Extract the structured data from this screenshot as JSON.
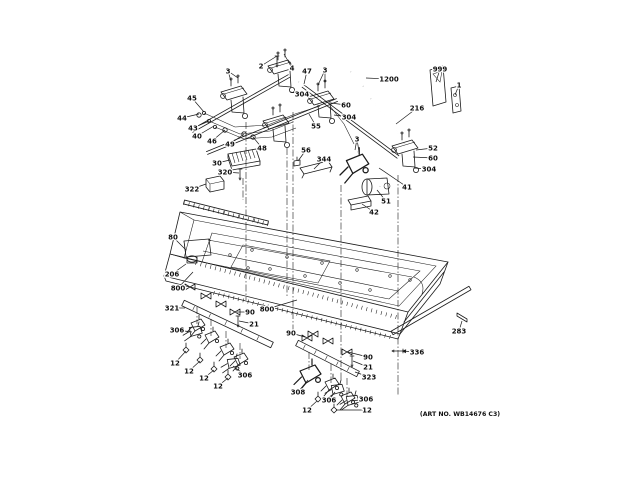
{
  "figure": {
    "art_no": "(ART NO. WB14676 C3)",
    "colors": {
      "line": "#1a1a1a",
      "background": "#ffffff",
      "label": "#111111"
    }
  },
  "callouts": [
    {
      "t": "3",
      "x": 228,
      "y": 71,
      "a": [
        [
          231,
          81
        ],
        [
          238,
          78
        ]
      ]
    },
    {
      "t": "2",
      "x": 261,
      "y": 66,
      "a": [
        [
          277,
          56
        ]
      ]
    },
    {
      "t": "4",
      "x": 292,
      "y": 68,
      "a": [
        [
          284,
          54
        ]
      ]
    },
    {
      "t": "47",
      "x": 307,
      "y": 71,
      "a": [
        [
          304,
          84
        ]
      ]
    },
    {
      "t": "3",
      "x": 325,
      "y": 70,
      "a": [
        [
          318,
          85
        ],
        [
          325,
          82
        ]
      ]
    },
    {
      "t": "45",
      "x": 192,
      "y": 98,
      "a": [
        [
          204,
          112
        ]
      ]
    },
    {
      "t": "304",
      "x": 302,
      "y": 94,
      "a": [
        [
          290,
          92
        ]
      ]
    },
    {
      "t": "60",
      "x": 346,
      "y": 105,
      "a": [
        [
          331,
          103
        ]
      ]
    },
    {
      "t": "44",
      "x": 182,
      "y": 118,
      "a": [
        [
          199,
          114
        ]
      ]
    },
    {
      "t": "304",
      "x": 349,
      "y": 117,
      "a": [
        [
          334,
          115
        ]
      ]
    },
    {
      "t": "43",
      "x": 193,
      "y": 128,
      "a": [
        [
          209,
          121
        ]
      ]
    },
    {
      "t": "40",
      "x": 197,
      "y": 136,
      "a": [
        [
          214,
          126
        ]
      ]
    },
    {
      "t": "46",
      "x": 212,
      "y": 141,
      "a": [
        [
          225,
          130
        ]
      ]
    },
    {
      "t": "49",
      "x": 230,
      "y": 144,
      "a": [
        [
          244,
          134
        ]
      ]
    },
    {
      "t": "48",
      "x": 262,
      "y": 148,
      "a": [
        [
          253,
          137
        ]
      ]
    },
    {
      "t": "55",
      "x": 316,
      "y": 126,
      "a": [
        [
          309,
          114
        ]
      ]
    },
    {
      "t": "56",
      "x": 306,
      "y": 150,
      "a": [
        [
          298,
          161
        ]
      ]
    },
    {
      "t": "344",
      "x": 324,
      "y": 159,
      "a": [
        [
          314,
          169
        ]
      ]
    },
    {
      "t": "30",
      "x": 217,
      "y": 163,
      "a": [
        [
          230,
          160
        ]
      ]
    },
    {
      "t": "320",
      "x": 225,
      "y": 172,
      "a": [
        [
          239,
          173
        ]
      ]
    },
    {
      "t": "322",
      "x": 192,
      "y": 189,
      "a": [
        [
          206,
          184
        ]
      ]
    },
    {
      "t": "1200",
      "x": 389,
      "y": 79,
      "a": [
        [
          366,
          78
        ]
      ]
    },
    {
      "t": "999",
      "x": 440,
      "y": 69,
      "a": [
        [
          436,
          82
        ]
      ]
    },
    {
      "t": "1",
      "x": 459,
      "y": 85,
      "a": [
        [
          455,
          95
        ]
      ]
    },
    {
      "t": "216",
      "x": 417,
      "y": 108,
      "a": [
        [
          396,
          124
        ]
      ]
    },
    {
      "t": "3",
      "x": 357,
      "y": 139,
      "a": [
        [
          355,
          150
        ],
        [
          359,
          152
        ]
      ]
    },
    {
      "t": "52",
      "x": 433,
      "y": 148,
      "a": [
        [
          416,
          150
        ]
      ]
    },
    {
      "t": "60",
      "x": 433,
      "y": 158,
      "a": [
        [
          413,
          157
        ]
      ]
    },
    {
      "t": "304",
      "x": 429,
      "y": 169,
      "a": [
        [
          414,
          168
        ]
      ]
    },
    {
      "t": "41",
      "x": 407,
      "y": 187,
      "a": [
        [
          379,
          168
        ]
      ]
    },
    {
      "t": "51",
      "x": 386,
      "y": 201,
      "a": [
        [
          377,
          190
        ]
      ]
    },
    {
      "t": "42",
      "x": 374,
      "y": 212,
      "a": [
        [
          362,
          204
        ]
      ]
    },
    {
      "t": "80",
      "x": 173,
      "y": 237,
      "a": [
        [
          186,
          250
        ]
      ]
    },
    {
      "t": "206",
      "x": 172,
      "y": 274,
      "a": [
        [
          186,
          264
        ]
      ]
    },
    {
      "t": "800",
      "x": 178,
      "y": 288,
      "a": [
        [
          193,
          272
        ]
      ]
    },
    {
      "t": "800",
      "x": 267,
      "y": 309,
      "a": [
        [
          297,
          300
        ]
      ]
    },
    {
      "t": "321",
      "x": 172,
      "y": 308,
      "a": [
        [
          185,
          308
        ]
      ]
    },
    {
      "t": "90",
      "x": 250,
      "y": 312,
      "a": [
        [
          237,
          312
        ]
      ]
    },
    {
      "t": "21",
      "x": 254,
      "y": 324,
      "a": [
        [
          239,
          321
        ]
      ]
    },
    {
      "t": "306",
      "x": 177,
      "y": 330,
      "a": [
        [
          192,
          332
        ]
      ]
    },
    {
      "t": "12",
      "x": 175,
      "y": 363,
      "a": [
        [
          186,
          351
        ]
      ]
    },
    {
      "t": "12",
      "x": 189,
      "y": 371,
      "a": [
        [
          200,
          361
        ]
      ]
    },
    {
      "t": "12",
      "x": 204,
      "y": 378,
      "a": [
        [
          214,
          370
        ]
      ]
    },
    {
      "t": "12",
      "x": 218,
      "y": 386,
      "a": [
        [
          228,
          378
        ]
      ]
    },
    {
      "t": "306",
      "x": 245,
      "y": 375,
      "a": [
        [
          233,
          366
        ]
      ]
    },
    {
      "t": "90",
      "x": 291,
      "y": 333,
      "a": [
        [
          305,
          337
        ]
      ]
    },
    {
      "t": "90",
      "x": 368,
      "y": 357,
      "a": [
        [
          348,
          352
        ]
      ]
    },
    {
      "t": "21",
      "x": 368,
      "y": 367,
      "a": [
        [
          353,
          361
        ]
      ]
    },
    {
      "t": "323",
      "x": 369,
      "y": 377,
      "a": [
        [
          355,
          372
        ]
      ]
    },
    {
      "t": "308",
      "x": 298,
      "y": 392,
      "a": [
        [
          308,
          380
        ]
      ]
    },
    {
      "t": "306",
      "x": 329,
      "y": 400,
      "a": [
        [
          335,
          392
        ]
      ]
    },
    {
      "t": "306",
      "x": 366,
      "y": 399,
      "a": [
        [
          352,
          401
        ]
      ]
    },
    {
      "t": "12",
      "x": 307,
      "y": 410,
      "a": [
        [
          317,
          401
        ]
      ]
    },
    {
      "t": "12",
      "x": 367,
      "y": 410,
      "a": [
        [
          336,
          410
        ]
      ]
    },
    {
      "t": "283",
      "x": 459,
      "y": 331,
      "a": [
        [
          462,
          321
        ]
      ]
    },
    {
      "t": "336",
      "x": 417,
      "y": 352,
      "a": [
        [
          402,
          351
        ]
      ],
      "arrow": true
    }
  ],
  "drawing": {
    "pipes": [
      {
        "x1": 192,
        "y1": 131,
        "x2": 289,
        "y2": 76,
        "n": "manifold-pipe-rear"
      },
      {
        "x1": 207,
        "y1": 153,
        "x2": 337,
        "y2": 100,
        "n": "manifold-pipe-front"
      },
      {
        "x1": 303,
        "y1": 86,
        "x2": 398,
        "y2": 157,
        "n": "supply-pipe-55"
      }
    ],
    "bars": [
      {
        "x1": 183,
        "y1": 303,
        "x2": 272,
        "y2": 345,
        "w": 3,
        "slots": true,
        "n": "lower-manifold-left-321"
      },
      {
        "x1": 297,
        "y1": 343,
        "x2": 358,
        "y2": 374,
        "w": 3,
        "slots": true,
        "n": "lower-manifold-center-323"
      },
      {
        "x1": 392,
        "y1": 333,
        "x2": 470,
        "y2": 288,
        "w": 2,
        "slots": false,
        "n": "front-trim-rail"
      },
      {
        "x1": 184,
        "y1": 202,
        "x2": 268,
        "y2": 223,
        "w": 2,
        "slots": true,
        "n": "rear-support-rail"
      }
    ],
    "tubes": [
      {
        "pts": [
          [
            371,
            99
          ],
          [
            380,
            110
          ],
          [
            391,
            123
          ],
          [
            400,
            136
          ],
          [
            404,
            143
          ]
        ],
        "n": "flex-hose-216"
      },
      {
        "pts": [
          [
            351,
            72
          ],
          [
            357,
            78
          ],
          [
            363,
            86
          ]
        ],
        "n": "hose-1200"
      },
      {
        "pts": [
          [
            299,
            82
          ],
          [
            311,
            87
          ],
          [
            326,
            94
          ]
        ],
        "n": "pipe-47"
      },
      {
        "pts": [
          [
            358,
            152
          ],
          [
            372,
            160
          ],
          [
            382,
            172
          ],
          [
            380,
            186
          ]
        ],
        "n": "pipe-41"
      }
    ],
    "wires": [
      {
        "pts": [
          [
            204,
            113
          ],
          [
            235,
            127
          ],
          [
            268,
            125
          ],
          [
            295,
            114
          ],
          [
            320,
            106
          ]
        ],
        "dot": true,
        "n": "igniter-wire-1"
      },
      {
        "pts": [
          [
            209,
            121
          ],
          [
            240,
            134
          ],
          [
            270,
            131
          ],
          [
            293,
            122
          ]
        ],
        "dot": true,
        "n": "igniter-wire-2"
      },
      {
        "pts": [
          [
            215,
            127
          ],
          [
            244,
            139
          ],
          [
            272,
            137
          ],
          [
            296,
            128
          ]
        ],
        "dot": true,
        "n": "igniter-wire-3"
      },
      {
        "pts": [
          [
            330,
            106
          ],
          [
            344,
            124
          ],
          [
            354,
            144
          ]
        ],
        "dot": false,
        "n": "igniter-wire-4"
      }
    ],
    "parts": [
      {
        "s": "burner",
        "x": 234,
        "y": 96,
        "n": "valve-assembly-a"
      },
      {
        "s": "burner",
        "x": 281,
        "y": 70,
        "n": "valve-assembly-b"
      },
      {
        "s": "burner",
        "x": 321,
        "y": 101,
        "n": "valve-assembly-c"
      },
      {
        "s": "burner",
        "x": 276,
        "y": 125,
        "n": "valve-assembly-d"
      },
      {
        "s": "burner",
        "x": 405,
        "y": 150,
        "n": "valve-assembly-e"
      },
      {
        "s": "valve",
        "x": 356,
        "y": 167,
        "sc": 1.6,
        "n": "valve-f"
      },
      {
        "s": "module",
        "x": 243,
        "y": 161,
        "n": "spark-module-30"
      },
      {
        "s": "box",
        "x": 215,
        "y": 185,
        "n": "junction-box-322"
      },
      {
        "s": "brk",
        "x": 316,
        "y": 170,
        "n": "bracket-344"
      },
      {
        "s": "clipsm",
        "x": 297,
        "y": 163,
        "n": "clip-56"
      },
      {
        "s": "motor",
        "x": 376,
        "y": 186,
        "n": "regulator-51"
      },
      {
        "s": "ubrk",
        "x": 359,
        "y": 203,
        "n": "bracket-42"
      },
      {
        "s": "sheet",
        "x": 437,
        "y": 88,
        "n": "literature-999"
      },
      {
        "s": "plate",
        "x": 455,
        "y": 100,
        "n": "plate-1"
      },
      {
        "s": "spark",
        "x": 197,
        "y": 250,
        "n": "spark-module-80-206"
      },
      {
        "s": "rod",
        "x": 462,
        "y": 317,
        "n": "screw-283"
      },
      {
        "s": "screw",
        "x": 238,
        "y": 321,
        "n": "screw-21-left"
      },
      {
        "s": "screw",
        "x": 352,
        "y": 361,
        "n": "screw-21-center"
      },
      {
        "s": "screw",
        "x": 240,
        "y": 174,
        "n": "screw-320"
      },
      {
        "s": "screw",
        "x": 398,
        "y": 351,
        "r": 90,
        "n": "screw-336"
      },
      {
        "s": "screw",
        "x": 277,
        "y": 61,
        "n": "screw-2-4"
      },
      {
        "s": "clip",
        "x": 190,
        "y": 287,
        "n": "clip-800"
      },
      {
        "s": "clip",
        "x": 206,
        "y": 296,
        "n": "clip-800"
      },
      {
        "s": "clip",
        "x": 221,
        "y": 304,
        "n": "clip-800"
      },
      {
        "s": "clip",
        "x": 235,
        "y": 312,
        "n": "clip-90"
      },
      {
        "s": "clip",
        "x": 307,
        "y": 338,
        "n": "clip-90"
      },
      {
        "s": "clip",
        "x": 313,
        "y": 334,
        "n": "clip"
      },
      {
        "s": "clip",
        "x": 328,
        "y": 341,
        "n": "clip"
      },
      {
        "s": "clip",
        "x": 347,
        "y": 352,
        "n": "clip-90"
      },
      {
        "s": "valve",
        "x": 197,
        "y": 327,
        "n": "gas-valve"
      },
      {
        "s": "valve",
        "x": 211,
        "y": 339,
        "n": "gas-valve"
      },
      {
        "s": "valve",
        "x": 226,
        "y": 351,
        "n": "gas-valve"
      },
      {
        "s": "valve",
        "x": 240,
        "y": 361,
        "n": "gas-valve"
      },
      {
        "s": "valve",
        "x": 309,
        "y": 377,
        "sc": 1.5,
        "n": "valve-308"
      },
      {
        "s": "valve",
        "x": 331,
        "y": 386,
        "n": "gas-valve"
      },
      {
        "s": "valve",
        "x": 347,
        "y": 400,
        "n": "gas-valve"
      },
      {
        "s": "valve",
        "x": 194,
        "y": 333,
        "r": 15,
        "n": "holder-306"
      },
      {
        "s": "valve",
        "x": 232,
        "y": 365,
        "r": 15,
        "n": "holder-306"
      },
      {
        "s": "valve",
        "x": 336,
        "y": 391,
        "r": 15,
        "n": "holder-306"
      },
      {
        "s": "valve",
        "x": 351,
        "y": 402,
        "r": 15,
        "n": "holder-306"
      },
      {
        "s": "nozzle",
        "x": 186,
        "y": 350,
        "n": "orifice-12"
      },
      {
        "s": "nozzle",
        "x": 200,
        "y": 360,
        "n": "orifice-12"
      },
      {
        "s": "nozzle",
        "x": 214,
        "y": 369,
        "n": "orifice-12"
      },
      {
        "s": "nozzle",
        "x": 228,
        "y": 377,
        "n": "orifice-12"
      },
      {
        "s": "nozzle",
        "x": 318,
        "y": 399,
        "n": "orifice-12"
      },
      {
        "s": "nozzle",
        "x": 334,
        "y": 410,
        "n": "orifice-12"
      },
      {
        "s": "ring",
        "x": 199,
        "y": 115,
        "n": "wire-terminal"
      },
      {
        "s": "ring",
        "x": 225,
        "y": 130,
        "n": "fitting-46"
      },
      {
        "s": "ring",
        "x": 244,
        "y": 134,
        "n": "foot-49"
      },
      {
        "s": "ring",
        "x": 253,
        "y": 137,
        "n": "foot-48"
      }
    ],
    "dashes": [
      [
        246,
        122,
        300
      ],
      [
        293,
        112,
        334
      ],
      [
        287,
        148,
        298
      ],
      [
        341,
        185,
        380
      ],
      [
        398,
        175,
        395
      ],
      [
        243,
        178,
        200
      ],
      [
        197,
        307,
        324
      ],
      [
        211,
        319,
        336
      ],
      [
        226,
        331,
        348
      ],
      [
        240,
        343,
        359
      ],
      [
        309,
        352,
        370
      ],
      [
        331,
        364,
        383
      ],
      [
        347,
        378,
        396
      ]
    ],
    "holes": [
      [
        252,
        250
      ],
      [
        287,
        257
      ],
      [
        322,
        263
      ],
      [
        357,
        270
      ],
      [
        390,
        276
      ],
      [
        270,
        269
      ],
      [
        305,
        276
      ],
      [
        340,
        283
      ],
      [
        370,
        290
      ],
      [
        248,
        268
      ],
      [
        230,
        255
      ],
      [
        410,
        280
      ]
    ],
    "serr": [
      {
        "x1": 196,
        "y1": 263,
        "x2": 396,
        "y2": 317
      },
      {
        "x1": 214,
        "y1": 293,
        "x2": 390,
        "y2": 337
      },
      {
        "x1": 184,
        "y1": 203,
        "x2": 268,
        "y2": 224
      }
    ]
  }
}
